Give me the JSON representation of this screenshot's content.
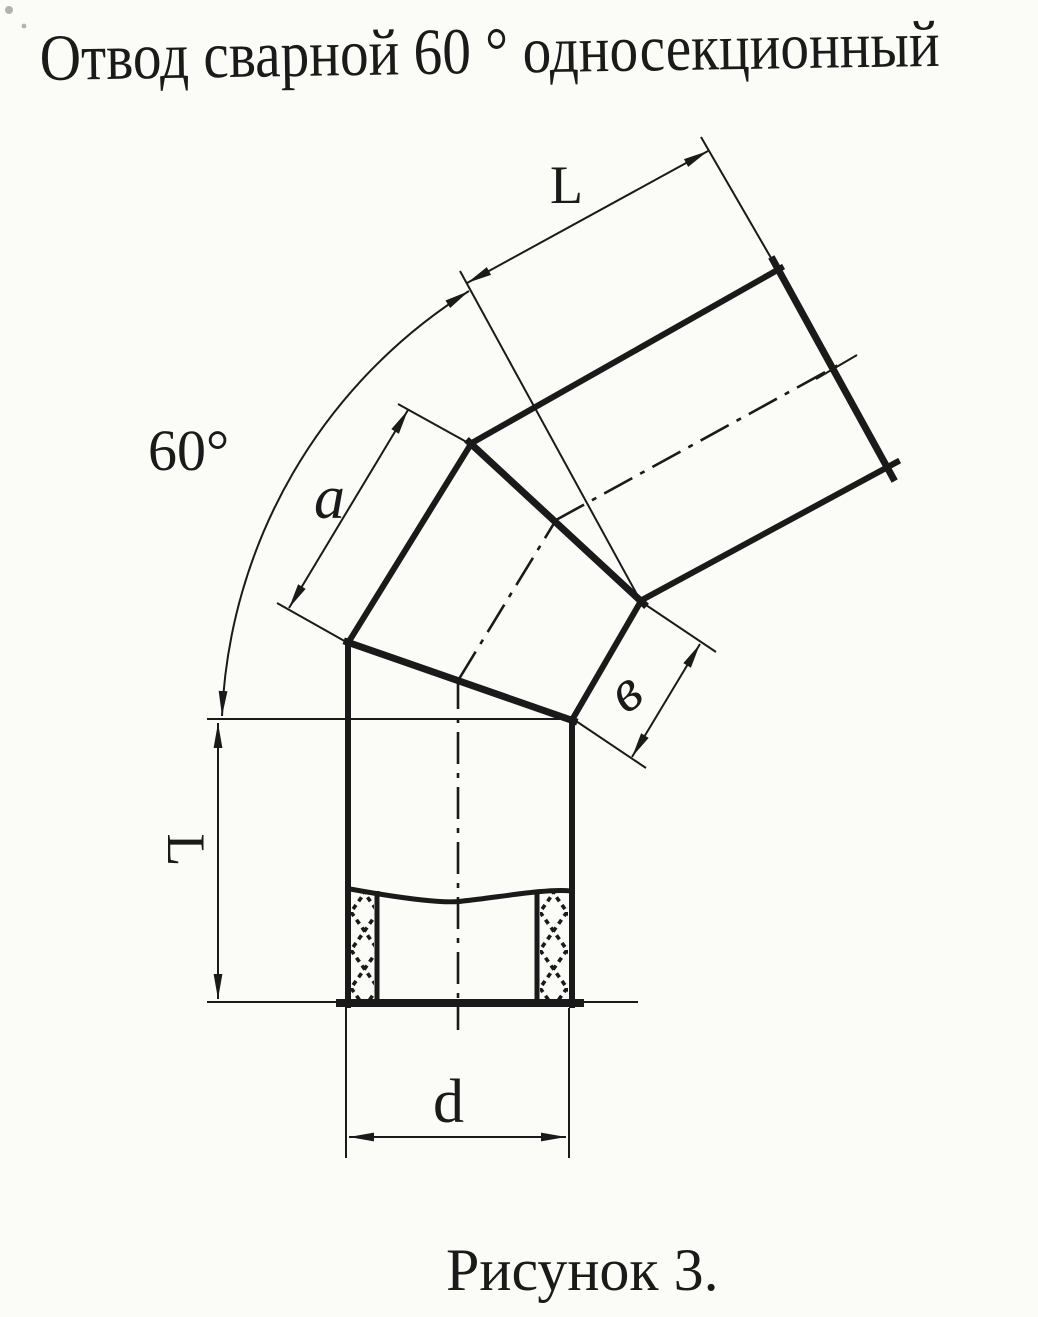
{
  "title": "Отвод сварной 60 ° односекционный",
  "caption": "Рисунок 3.",
  "labels": {
    "angle": "60°",
    "upper_section_length": "L",
    "intermediate_section_length": "a",
    "weld_edge_width": "в",
    "lower_section_length": "L",
    "diameter": "d"
  },
  "colors": {
    "ink": "#1a1a1a",
    "paper": "#fbfbf8"
  }
}
